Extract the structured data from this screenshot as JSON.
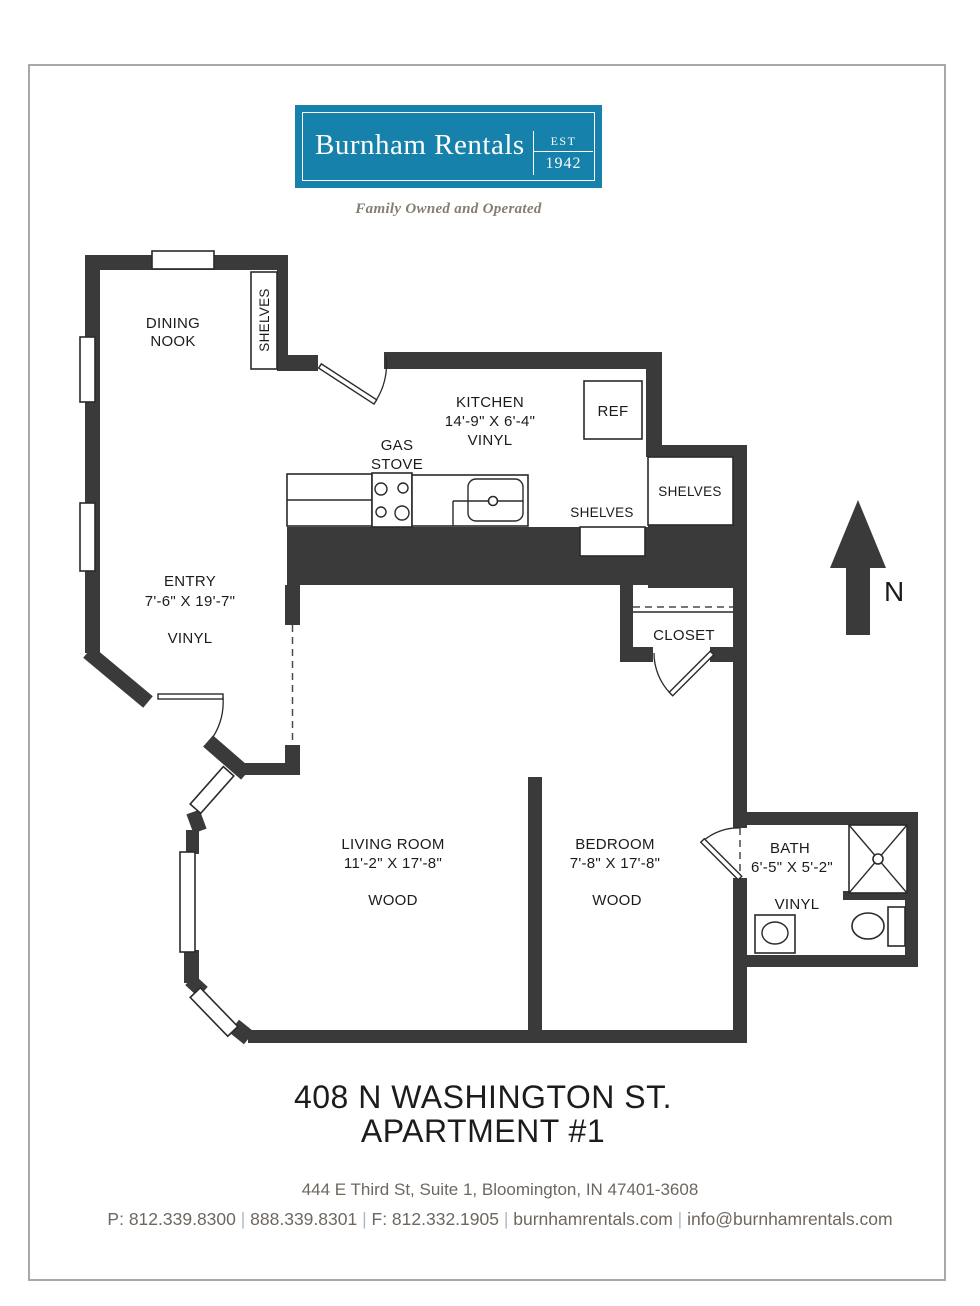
{
  "logo": {
    "name": "Burnham Rentals",
    "est_label": "EST",
    "est_year": "1942",
    "tagline": "Family Owned and Operated",
    "bg_color": "#1681AA"
  },
  "floorplan": {
    "wall_color": "#3a3a3a",
    "rooms": {
      "dining_nook": {
        "line1": "DINING",
        "line2": "NOOK"
      },
      "kitchen": {
        "name": "KITCHEN",
        "dims": "14'-9\" X 6'-4\"",
        "floor": "VINYL"
      },
      "entry": {
        "name": "ENTRY",
        "dims": "7'-6\" X 19'-7\"",
        "floor": "VINYL"
      },
      "living_room": {
        "name": "LIVING ROOM",
        "dims": "11'-2\" X 17'-8\"",
        "floor": "WOOD"
      },
      "bedroom": {
        "name": "BEDROOM",
        "dims": "7'-8\" X 17'-8\"",
        "floor": "WOOD"
      },
      "bath": {
        "name": "BATH",
        "dims": "6'-5\" X 5'-2\"",
        "floor": "VINYL"
      },
      "closet": {
        "name": "CLOSET"
      }
    },
    "labels": {
      "shelves_dining": "SHELVES",
      "shelves_kitchen": "SHELVES",
      "shelves_right": "SHELVES",
      "gas_stove_line1": "GAS",
      "gas_stove_line2": "STOVE",
      "ref": "REF",
      "north": "N"
    }
  },
  "title": {
    "line1": "408 N WASHINGTON ST.",
    "line2": "APARTMENT #1"
  },
  "footer": {
    "address": "444 E Third St, Suite 1, Bloomington, IN  47401-3608",
    "separator": "|",
    "contacts": [
      "P: 812.339.8300",
      "888.339.8301",
      "F: 812.332.1905",
      "burnhamrentals.com",
      "info@burnhamrentals.com"
    ]
  }
}
